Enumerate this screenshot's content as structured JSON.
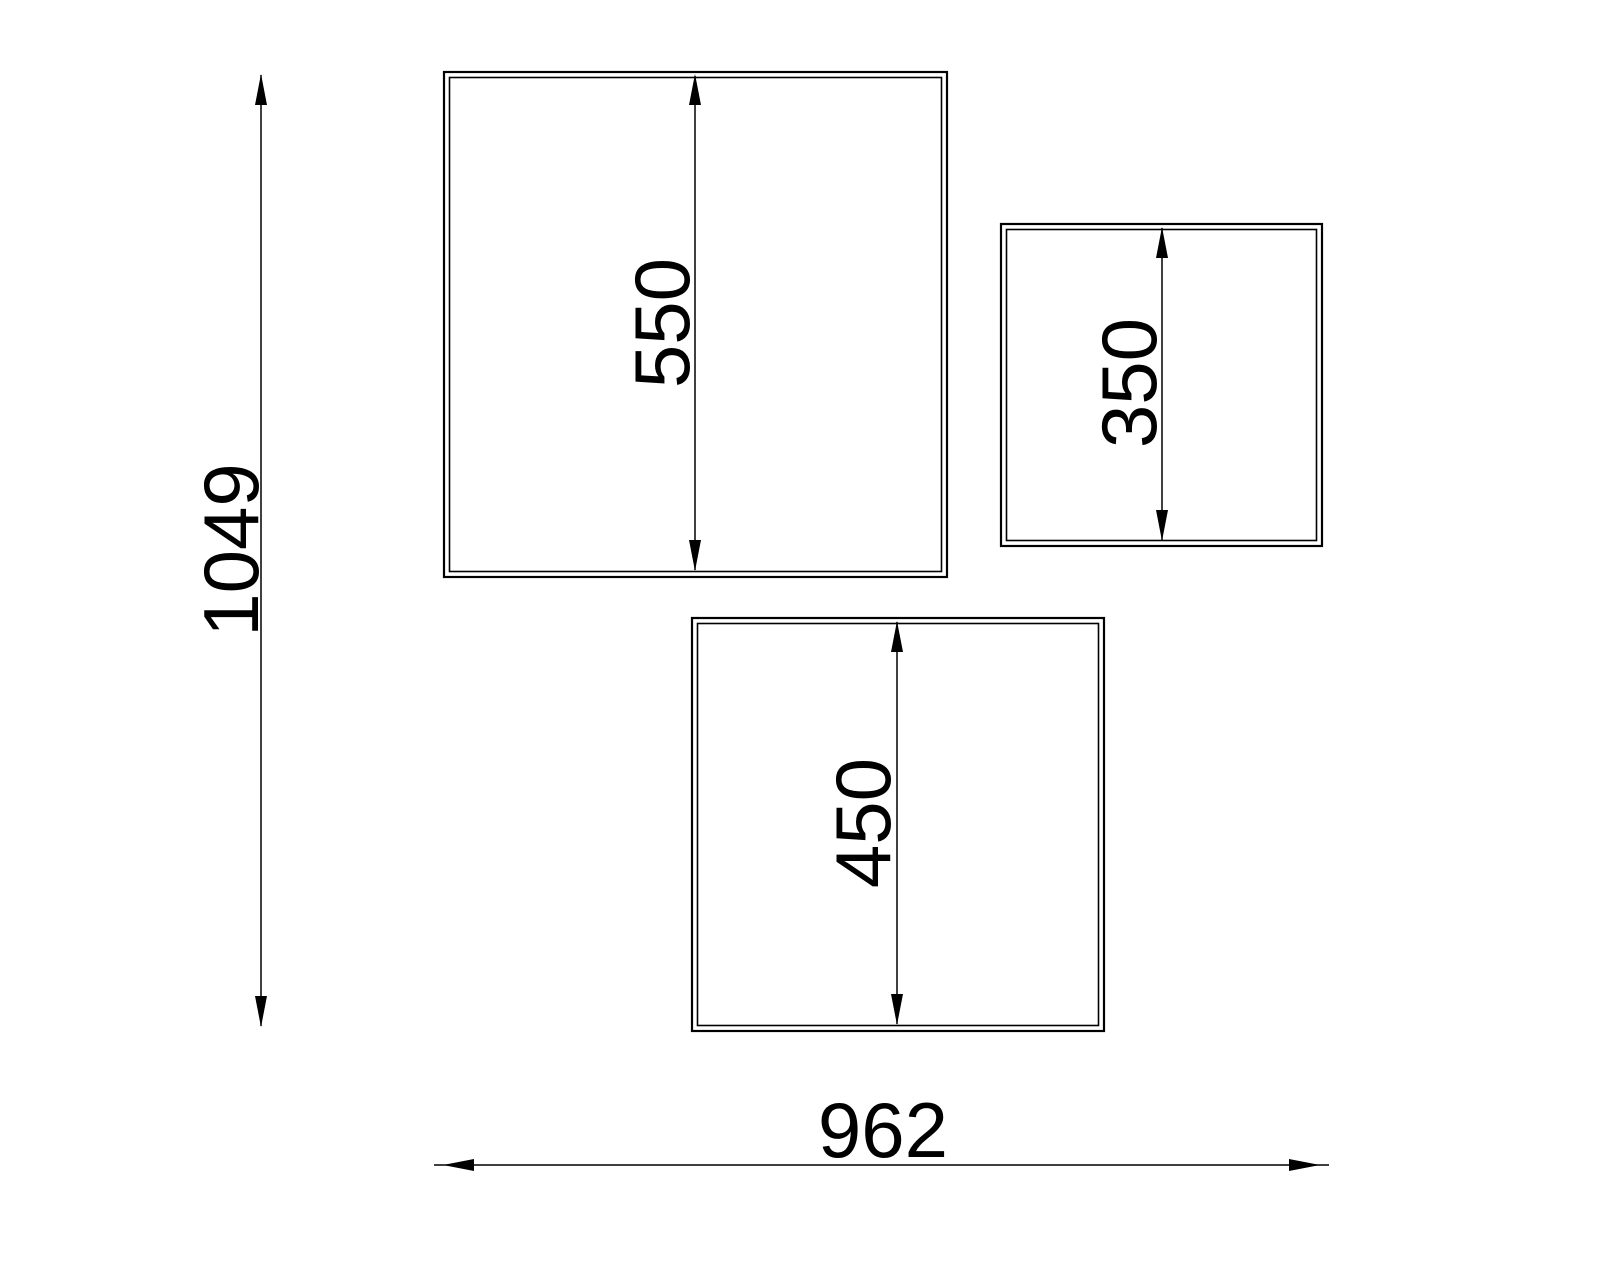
{
  "drawing": {
    "type": "technical-drawing",
    "background": "#ffffff",
    "line_color": "#000000",
    "panels": [
      {
        "name": "large-panel",
        "height_label": "550",
        "height_value": 550
      },
      {
        "name": "right-panel",
        "height_label": "350",
        "height_value": 350
      },
      {
        "name": "bottom-panel",
        "height_label": "450",
        "height_value": 450
      }
    ],
    "overall": {
      "height_label": "1049",
      "height_value": 1049,
      "width_label": "962",
      "width_value": 962
    }
  }
}
